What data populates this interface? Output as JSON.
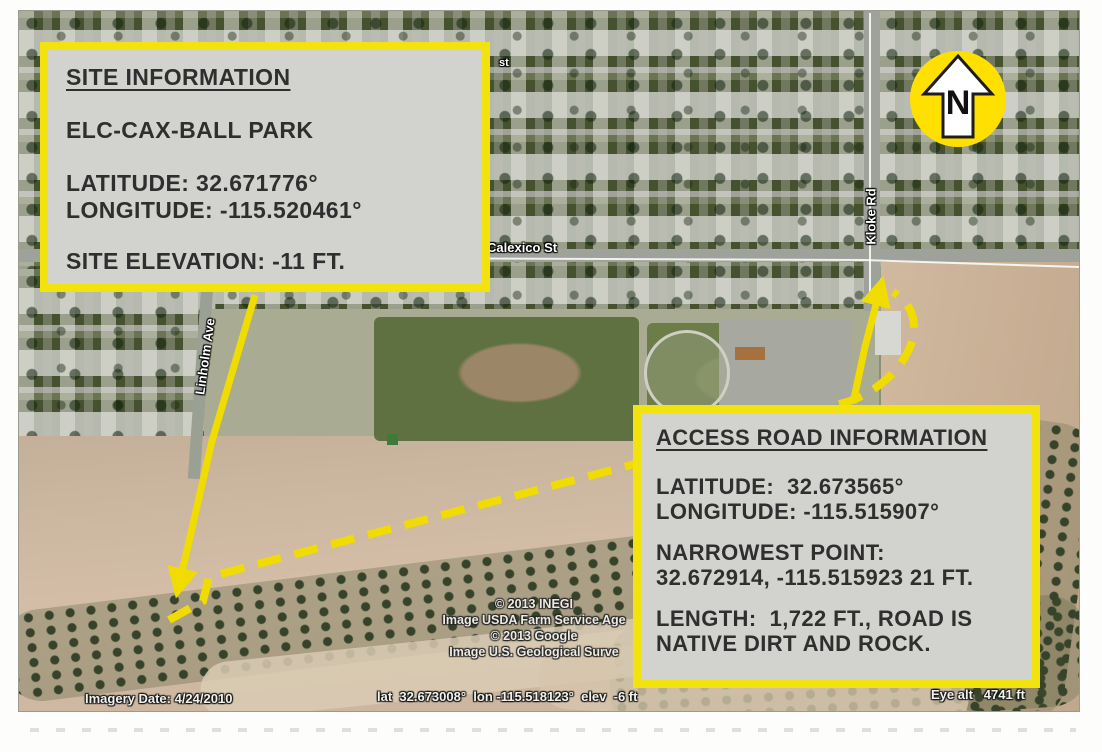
{
  "site_info": {
    "title": "SITE INFORMATION",
    "site_name": "ELC-CAX-BALL PARK",
    "latitude": "LATITUDE: 32.671776°",
    "longitude": "LONGITUDE: -115.520461°",
    "elevation": "SITE ELEVATION: -11 FT."
  },
  "access_road_info": {
    "title": "ACCESS ROAD INFORMATION",
    "latitude": "LATITUDE:  32.673565°",
    "longitude": "LONGITUDE: -115.515907°",
    "narrowest_point_label": "NARROWEST POINT:",
    "narrowest_point_value": "32.672914, -115.515923 21 FT.",
    "length_line_1": "LENGTH:  1,722 FT., ROAD IS",
    "length_line_2": "NATIVE DIRT AND ROCK."
  },
  "compass": {
    "letter": "N"
  },
  "street_labels": {
    "calexico": "Calexico St",
    "kloke": "Kloke Rd",
    "linholm": "Linholm Ave",
    "partial_top": "st"
  },
  "attribution": {
    "line_1": "© 2013 INEGI",
    "line_2": "Image USDA Farm Service Age",
    "line_3": "© 2013 Google",
    "line_4": "Image U.S. Geological Surve"
  },
  "status_bar": {
    "imagery_date": "Imagery Date: 4/24/2010",
    "cursor_position": "lat  32.673008°  lon -115.518123°  elev  -6 ft",
    "eye_altitude": "Eye alt   4741 ft"
  },
  "colors": {
    "highlight_yellow": "#f2e20e",
    "dashed_route_yellow": "#f0dc00",
    "box_fill": "#d2d3cf",
    "box_text": "#2f2f2f"
  }
}
